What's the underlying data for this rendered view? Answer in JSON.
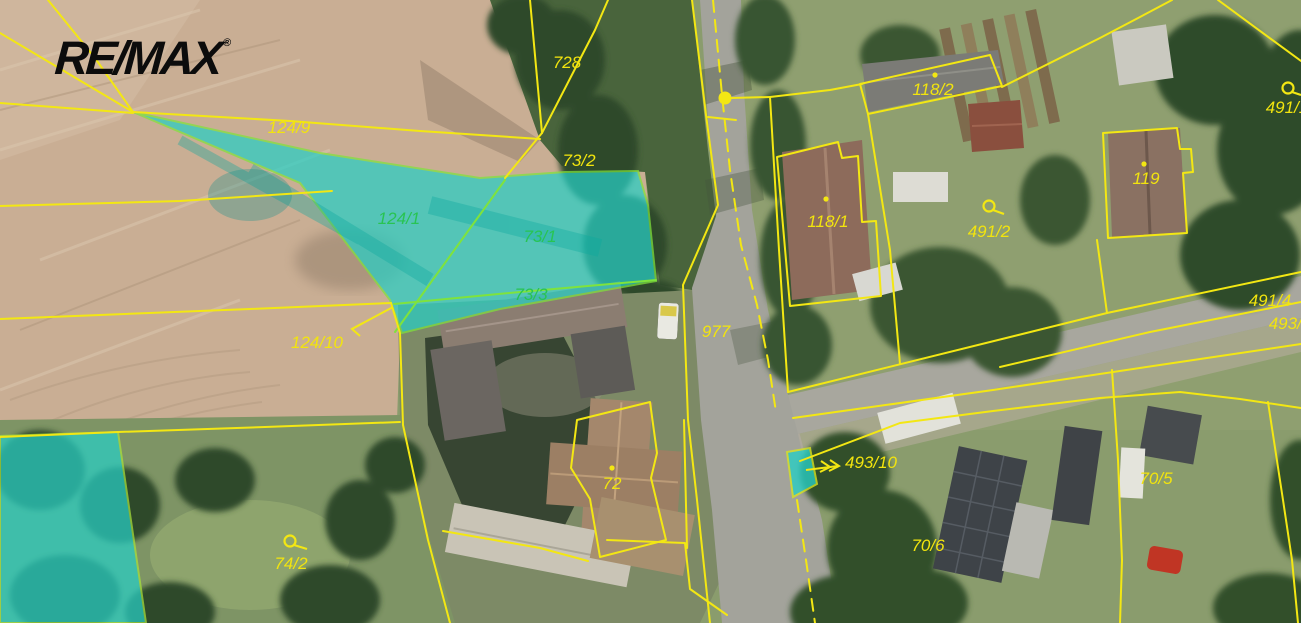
{
  "brand": {
    "logo_text": "RE/MAX",
    "registered_mark": "®"
  },
  "map": {
    "type": "cadastral-aerial-overlay",
    "colors": {
      "boundary_line": "#f3e713",
      "parcel_label": "#f2e40e",
      "highlight_fill": "#28cfc5",
      "highlight_border": "#7fe33c",
      "highlight_label": "#28c452"
    },
    "parcels": [
      {
        "label": "728",
        "highlighted": false,
        "marker": "none"
      },
      {
        "label": "124/9",
        "highlighted": false,
        "marker": "none"
      },
      {
        "label": "73/2",
        "highlighted": false,
        "marker": "none"
      },
      {
        "label": "124/1",
        "highlighted": true,
        "marker": "none"
      },
      {
        "label": "73/1",
        "highlighted": true,
        "marker": "none"
      },
      {
        "label": "73/3",
        "highlighted": true,
        "marker": "none"
      },
      {
        "label": "124/10",
        "highlighted": false,
        "marker": "arrow"
      },
      {
        "label": "977",
        "highlighted": false,
        "marker": "none"
      },
      {
        "label": "118/2",
        "highlighted": false,
        "marker": "dot"
      },
      {
        "label": "118/1",
        "highlighted": false,
        "marker": "dot"
      },
      {
        "label": "491/2",
        "highlighted": false,
        "marker": "slucka"
      },
      {
        "label": "119",
        "highlighted": false,
        "marker": "dot"
      },
      {
        "label": "491/1",
        "highlighted": false,
        "marker": "slucka"
      },
      {
        "label": "491/4",
        "highlighted": false,
        "marker": "none"
      },
      {
        "label": "493/4",
        "highlighted": false,
        "marker": "none"
      },
      {
        "label": "493/10",
        "highlighted": false,
        "marker": "arrow"
      },
      {
        "label": "70/6",
        "highlighted": false,
        "marker": "none"
      },
      {
        "label": "70/5",
        "highlighted": false,
        "marker": "none"
      },
      {
        "label": "72",
        "highlighted": false,
        "marker": "dot"
      },
      {
        "label": "74/2",
        "highlighted": false,
        "marker": "slucka"
      }
    ]
  }
}
